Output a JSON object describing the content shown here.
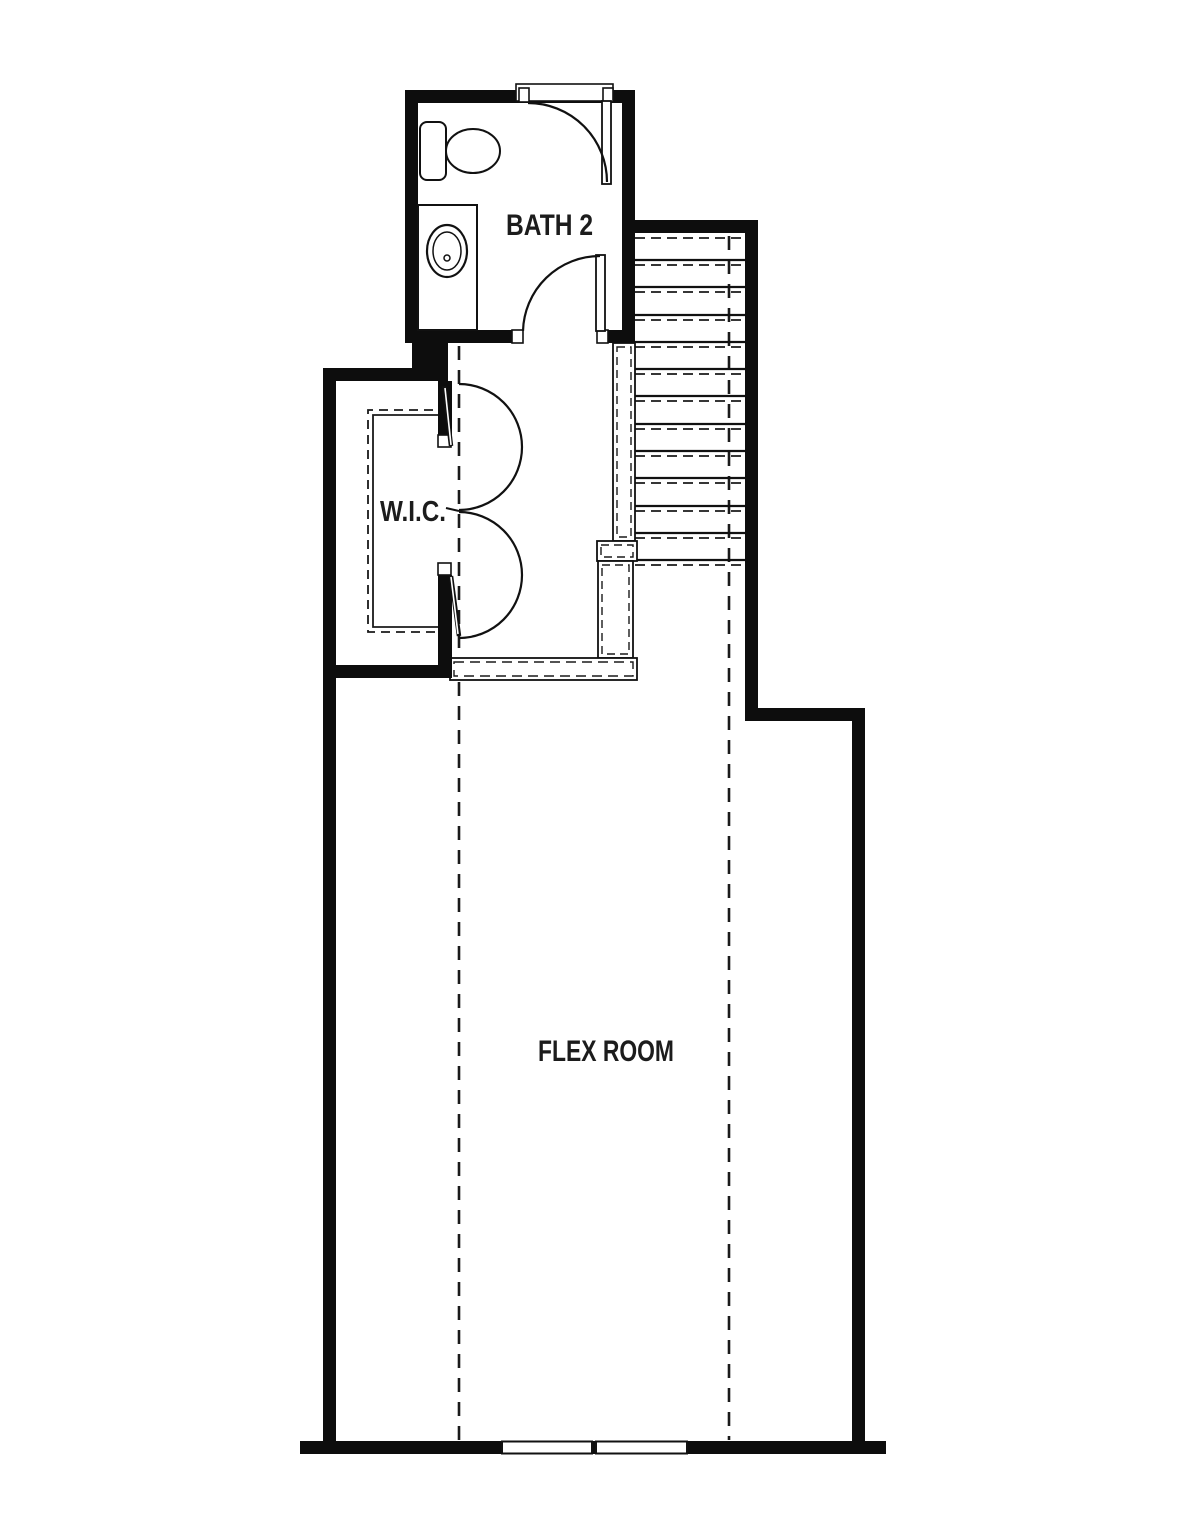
{
  "plan": {
    "kind": "floor-plan",
    "background": "#ffffff",
    "wall_color": "#0d0d0d",
    "line_color": "#1a1a1a",
    "rooms": {
      "bath": {
        "label": "BATH 2"
      },
      "wic": {
        "label": "W.I.C."
      },
      "flex": {
        "label": "FLEX ROOM"
      }
    },
    "fixtures": [
      "toilet-icon",
      "sink-vanity-icon",
      "door-swing-arc-icon",
      "double-closet-door-icon",
      "staircase-icon",
      "stair-railing-icon",
      "window-icon",
      "ceiling-break-dashed-line"
    ]
  }
}
